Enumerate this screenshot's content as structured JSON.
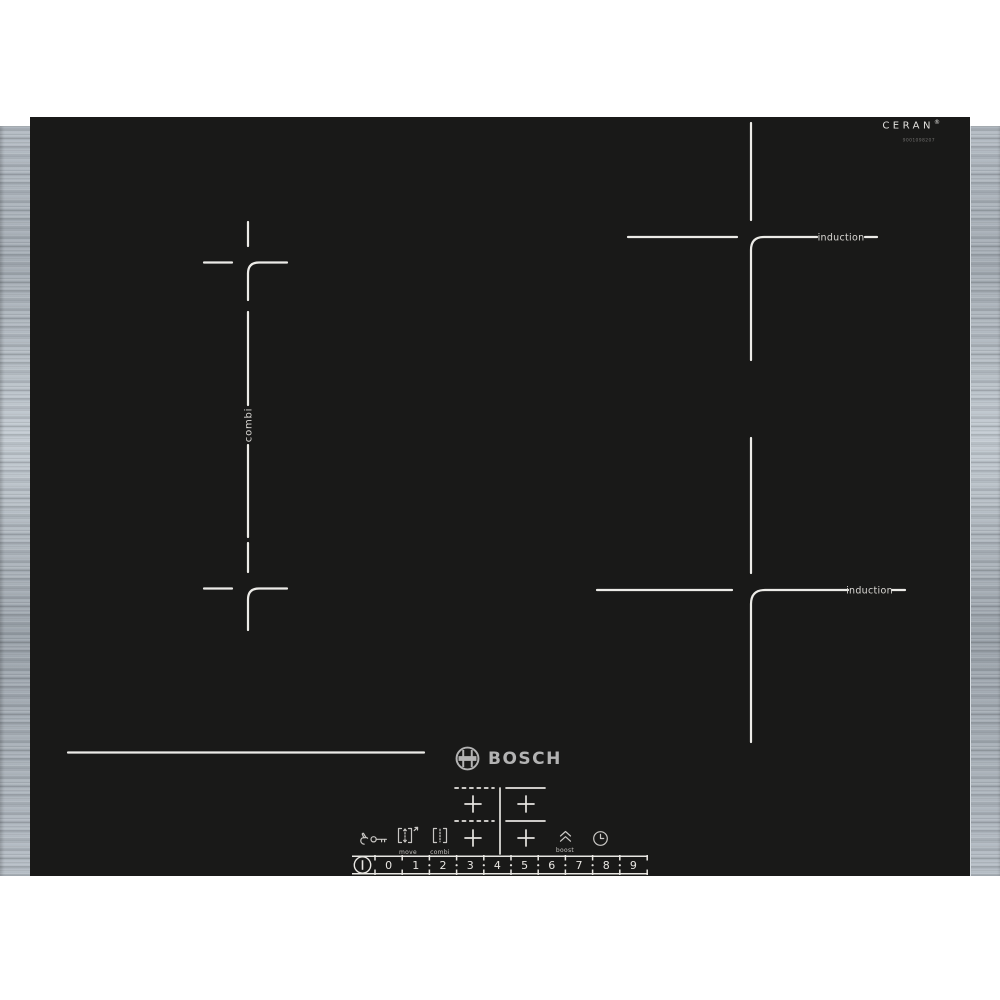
{
  "brand": {
    "name": "BOSCH"
  },
  "glass_branding": {
    "name": "CERAN",
    "trademark": "®",
    "part_number": "9001098207"
  },
  "zones": {
    "combi_label": "combi",
    "induction_rear_label": "induction",
    "induction_front_label": "induction"
  },
  "control_panel": {
    "child_lock": {
      "icon": "hand-and-key"
    },
    "move": {
      "label": "move",
      "icon": "brackets-vertical-arrows"
    },
    "combi": {
      "label": "combi",
      "icon": "brackets-dashed-line"
    },
    "boost": {
      "label": "boost",
      "icon": "double-chevron-up"
    },
    "timer": {
      "icon": "clock"
    },
    "power": {
      "icon": "circled-I"
    },
    "zone_selector": {
      "icon": "four-crosses-map"
    },
    "levels": [
      "0",
      "1",
      "2",
      "3",
      "4",
      "5",
      "6",
      "7",
      "8",
      "9"
    ],
    "level_separator": "·"
  },
  "colors": {
    "page_background": "#ffffff",
    "glass": "#191918",
    "markings": "#ecebe7",
    "steel_light": "#c2cad1",
    "steel_dark": "#9aa2aa",
    "logo_silver": "#b3b3b3"
  }
}
